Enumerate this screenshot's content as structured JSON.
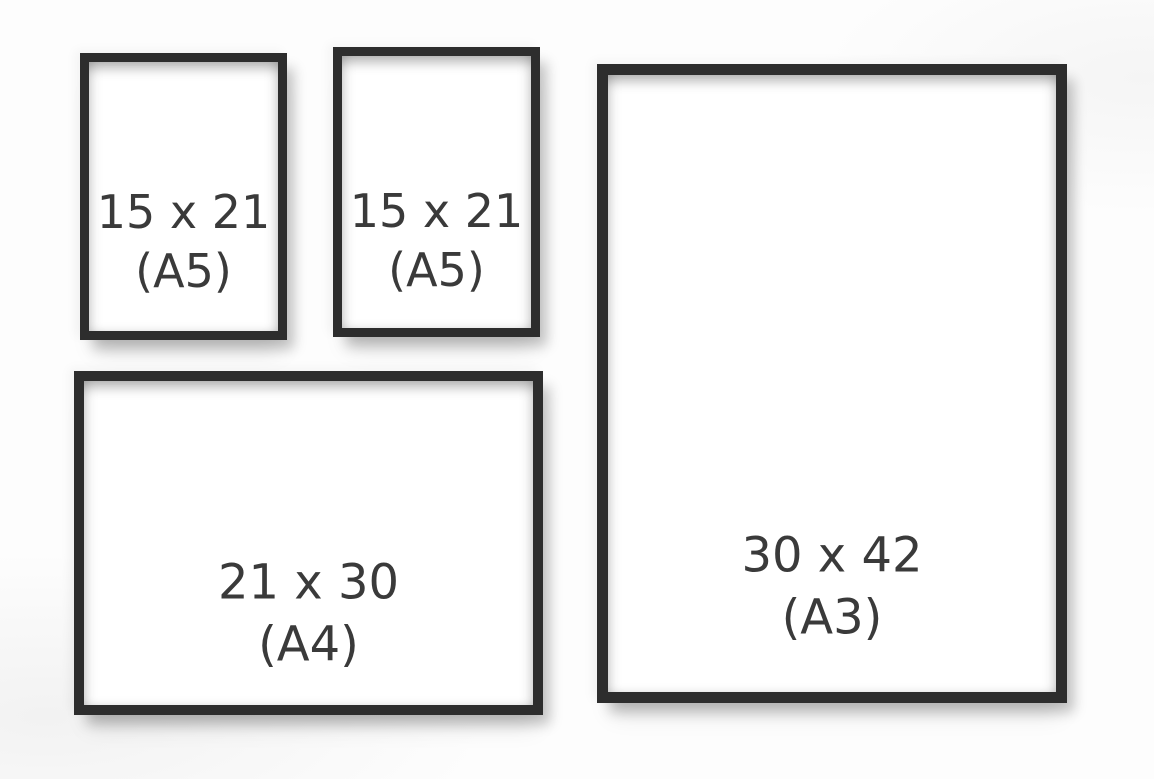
{
  "frames": [
    {
      "name": "frame-a5-left",
      "size": "15 x 21",
      "format": "(A5)"
    },
    {
      "name": "frame-a5-right",
      "size": "15 x 21",
      "format": "(A5)"
    },
    {
      "name": "frame-a4",
      "size": "21 x 30",
      "format": "(A4)"
    },
    {
      "name": "frame-a3",
      "size": "30 x 42",
      "format": "(A3)"
    }
  ],
  "colors": {
    "frame": "#2d2d2d",
    "paper": "#ffffff",
    "text": "#3a3a3a",
    "background": "#fdfdfd"
  }
}
